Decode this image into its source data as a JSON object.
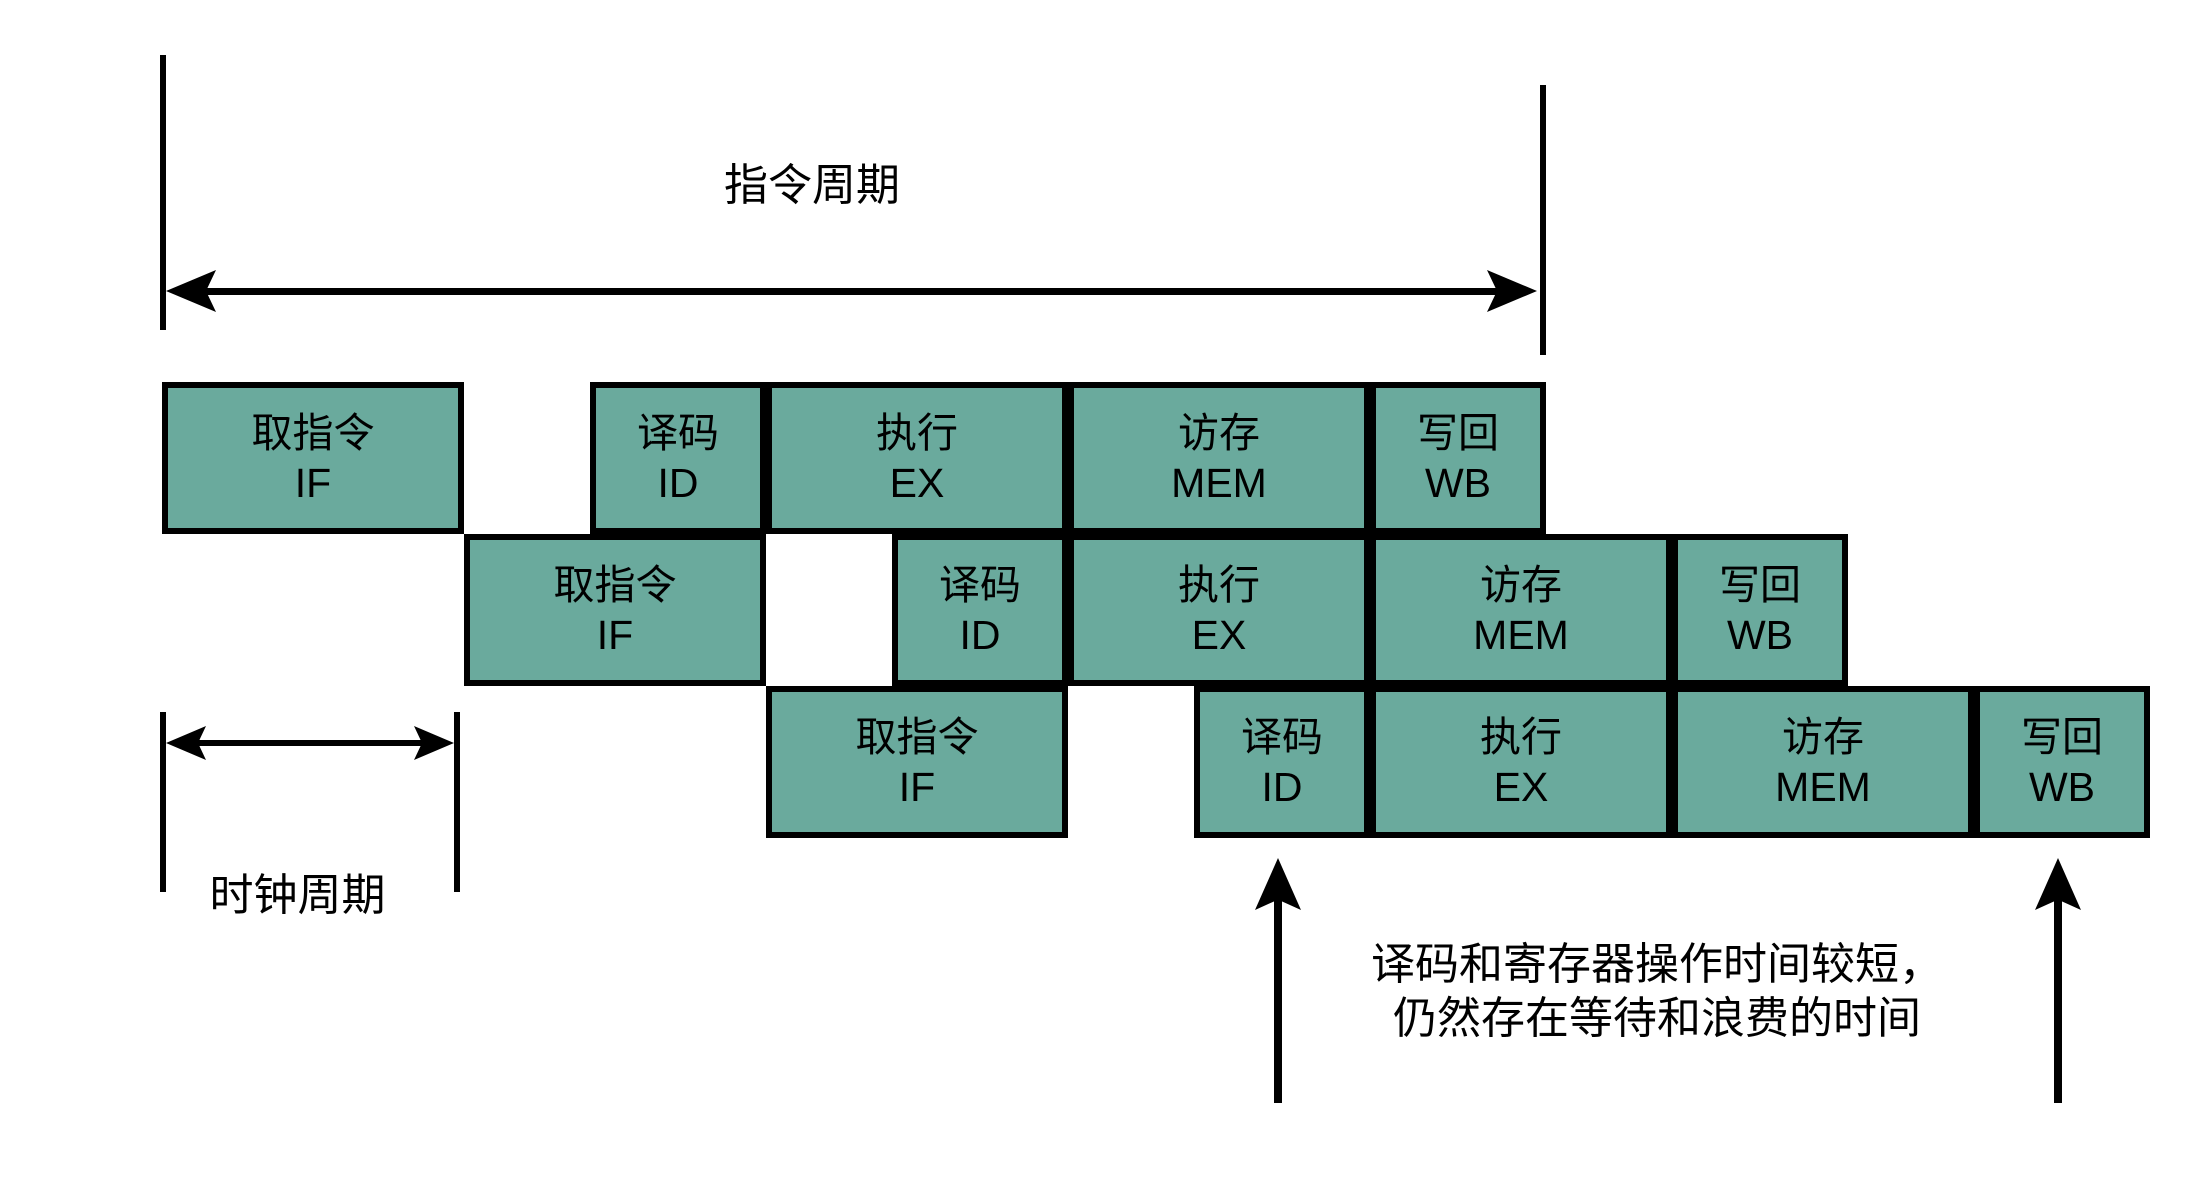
{
  "diagram": {
    "background": "#FFFFFF",
    "colors": {
      "box_fill": "#6AAA9D",
      "stroke": "#000000",
      "text": "#000000"
    },
    "instruction_cycle_label": "指令周期",
    "clock_cycle_label": "时钟周期",
    "note": {
      "line1": "译码和寄存器操作时间较短，",
      "line2": "仍然存在等待和浪费的时间"
    },
    "rows": [
      {
        "name": "instruction-1",
        "stages": [
          {
            "zh": "取指令",
            "en": "IF",
            "w": 302,
            "gap_before": 0
          },
          {
            "zh": "译码",
            "en": "ID",
            "w": 176,
            "gap_before": 126
          },
          {
            "zh": "执行",
            "en": "EX",
            "w": 302,
            "gap_before": 0
          },
          {
            "zh": "访存",
            "en": "MEM",
            "w": 302,
            "gap_before": 0
          },
          {
            "zh": "写回",
            "en": "WB",
            "w": 176,
            "gap_before": 0
          }
        ]
      },
      {
        "name": "instruction-2",
        "stages": [
          {
            "zh": "取指令",
            "en": "IF",
            "w": 302,
            "gap_before": 0
          },
          {
            "zh": "译码",
            "en": "ID",
            "w": 176,
            "gap_before": 126
          },
          {
            "zh": "执行",
            "en": "EX",
            "w": 302,
            "gap_before": 0
          },
          {
            "zh": "访存",
            "en": "MEM",
            "w": 302,
            "gap_before": 0
          },
          {
            "zh": "写回",
            "en": "WB",
            "w": 176,
            "gap_before": 0
          }
        ]
      },
      {
        "name": "instruction-3",
        "stages": [
          {
            "zh": "取指令",
            "en": "IF",
            "w": 302,
            "gap_before": 0
          },
          {
            "zh": "译码",
            "en": "ID",
            "w": 176,
            "gap_before": 126
          },
          {
            "zh": "执行",
            "en": "EX",
            "w": 302,
            "gap_before": 0
          },
          {
            "zh": "访存",
            "en": "MEM",
            "w": 302,
            "gap_before": 0
          },
          {
            "zh": "写回",
            "en": "WB",
            "w": 176,
            "gap_before": 0
          }
        ]
      }
    ],
    "layout": {
      "row_x": [
        162,
        464,
        766
      ],
      "row_y": [
        382,
        534,
        686
      ],
      "row_h": 152
    }
  }
}
